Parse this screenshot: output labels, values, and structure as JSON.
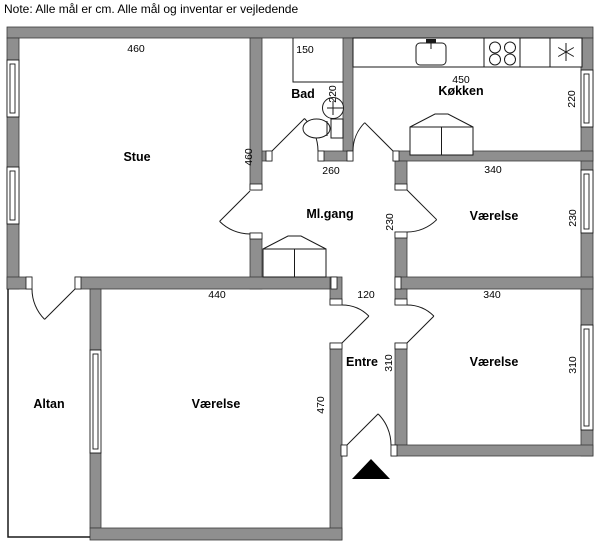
{
  "note": "Note: Alle mål er cm. Alle mål og inventar er vejledende",
  "colors": {
    "background": "#ffffff",
    "wall_fill": "#8f8f8f",
    "wall_stroke": "#3a3a3a",
    "line": "#1a1a1a",
    "text": "#000000"
  },
  "rooms": {
    "stue": "Stue",
    "bad": "Bad",
    "kokken": "Køkken",
    "mlgang": "Ml.gang",
    "vaerelse_ne": "Værelse",
    "vaerelse_se": "Værelse",
    "vaerelse_sw": "Værelse",
    "entre": "Entre",
    "altan": "Altan"
  },
  "dimensions": {
    "stue_top": "460",
    "stue_side": "460",
    "bad_width": "150",
    "kokken_width": "450",
    "kokken_left": "220",
    "kokken_right": "220",
    "mlgang_top": "260",
    "mlgang_side": "230",
    "vaerelse_ne_top": "340",
    "vaerelse_ne_side": "230",
    "vaerelse_sw_top": "440",
    "entre_top": "120",
    "vaerelse_se_top": "340",
    "entre_side": "310",
    "vaerelse_se_side": "310",
    "vaerelse_sw_side": "470"
  },
  "icons": {
    "refrigerator": "snowflake-symbol",
    "entrance": "entrance-triangle"
  }
}
